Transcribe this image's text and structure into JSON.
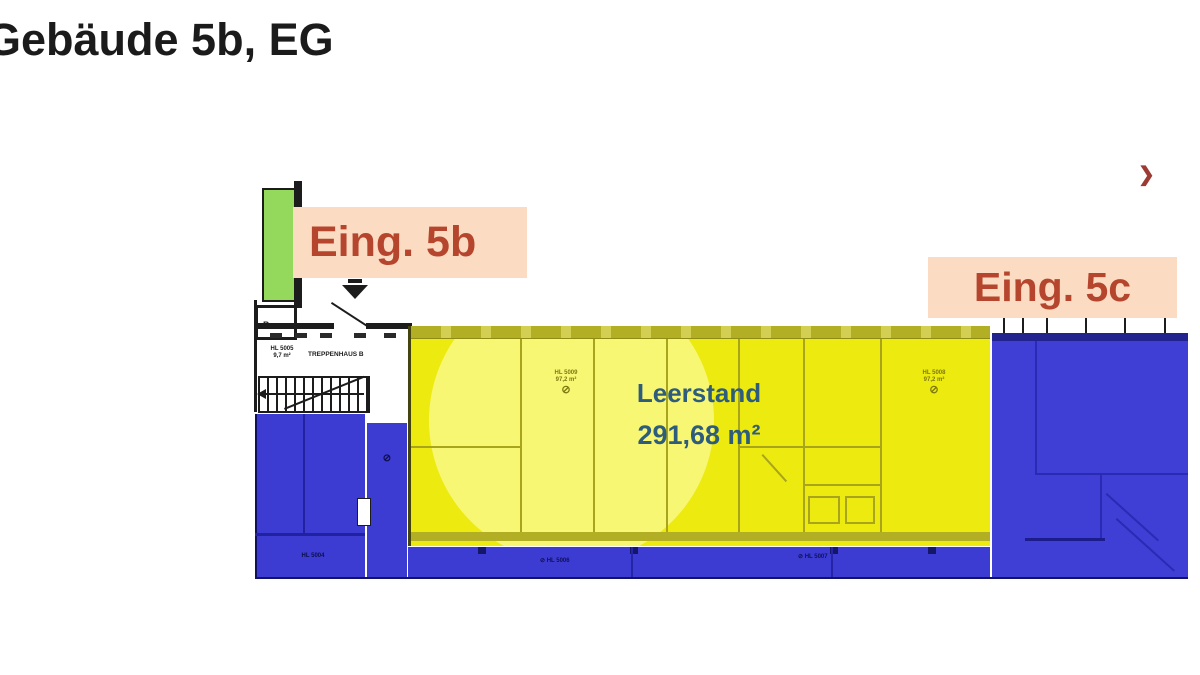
{
  "slide": {
    "title": "Gebäude 5b, EG",
    "nav_next": "❯"
  },
  "plan": {
    "entrances": {
      "eing_5b": "Eing. 5b",
      "eing_5c": "Eing. 5c"
    },
    "vacancy": {
      "label": "Leerstand",
      "area": "291,68 m²"
    },
    "stairwell": {
      "name": "TREPPENHAUS B",
      "tag_line1": "HL 5005",
      "tag_line2": "9,7 m²",
      "p": "P"
    },
    "room_tags": {
      "yellow_left": {
        "line1": "HL 5009",
        "line2": "97,2 m²",
        "symbol": "⊘"
      },
      "yellow_right": {
        "line1": "HL 5008",
        "line2": "97,2 m²",
        "symbol": "⊘"
      },
      "corridor_left": "⊘ HL 5006",
      "corridor_right": "⊘ HL 5007",
      "blue_left": "HL 5004"
    },
    "colors": {
      "vacant_yellow": "#edea10",
      "occupied_blue": "#3c3cd2",
      "entrance_green": "#94d95c",
      "label_bg": "#fbdcc2",
      "label_text": "#b5452c",
      "vacancy_text": "#2e5d7c"
    }
  }
}
